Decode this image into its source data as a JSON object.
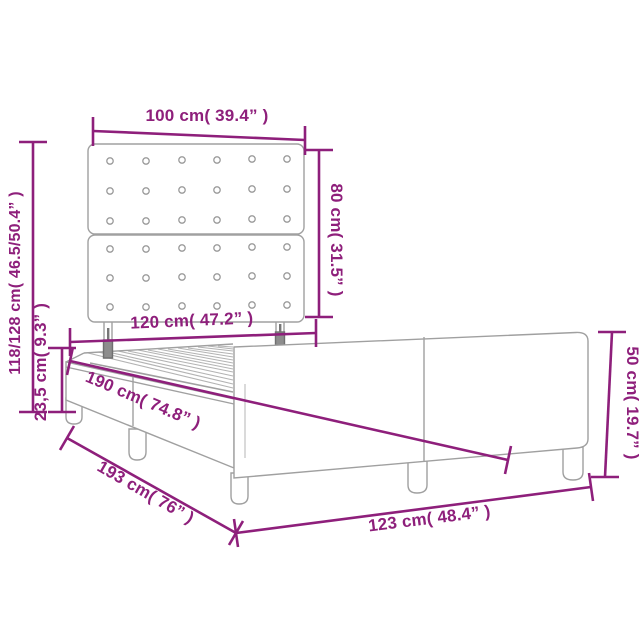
{
  "diagram": {
    "kind": "bed-frame-dimension-diagram",
    "accent_color": "#8e1f7b",
    "drawing_color": "#a0a0a0",
    "labels": {
      "headboard_width": "100 cm( 39.4” )",
      "headboard_height": "80 cm( 31.5” )",
      "overall_height": "118/128 cm( 46.5/50.4” )",
      "base_height": "23,5 cm( 9.3” )",
      "slat_width": "120 cm( 47.2” )",
      "slat_length": "190 cm( 74.8” )",
      "frame_length": "193 cm( 76” )",
      "frame_width": "123 cm( 48.4” )",
      "foot_height": "50 cm( 19.7” )"
    }
  }
}
